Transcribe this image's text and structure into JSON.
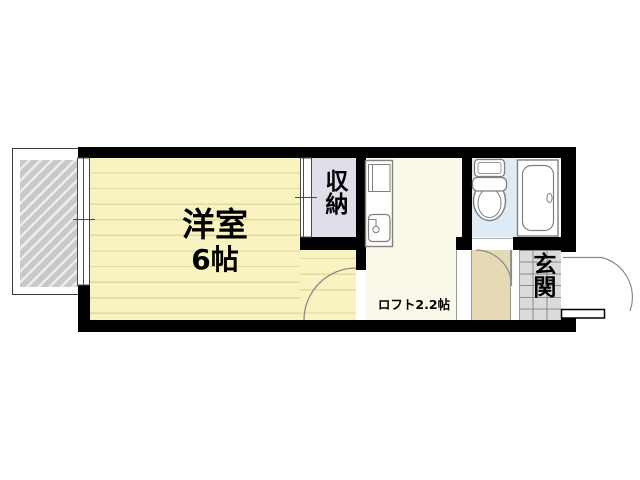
{
  "plan": {
    "type": "apartment-floorplan",
    "background_color": "#FFFFFF",
    "wall_color": "#000000",
    "rooms": {
      "main_room": {
        "name": "洋室",
        "size": "6帖",
        "floor_color": "#F9F3C1",
        "stripe_color": "#E4DA9E"
      },
      "closet": {
        "name": "収納",
        "floor_color": "#E0DEE9"
      },
      "loft_hall": {
        "name": "ロフト2.2帖",
        "floor_color": "#FAF8E9"
      },
      "entrance": {
        "name": "玄関",
        "floor_color": "#DBDBDB",
        "grid_color": "#8A8A8A"
      },
      "washroom": {
        "floor_color": "#DEEAF4"
      },
      "hallway": {
        "floor_color": "#E6D9B5"
      },
      "balcony": {
        "hatch_color": "#C9C9C9"
      }
    },
    "fixtures": {
      "toilet": "toilet-icon",
      "bathtub": "bathtub-icon",
      "kitchen_unit": "kitchen-sink-icon"
    },
    "openings": {
      "window": "sliding-window-left",
      "closet_doors": "sliding-doors",
      "entry_door": "outward-swing-door",
      "bath_door": "inward-swing-door",
      "room_door": "inward-swing-door"
    },
    "line_color": "#8A8A8A",
    "fixture_stroke_color": "#7F7F7F"
  }
}
